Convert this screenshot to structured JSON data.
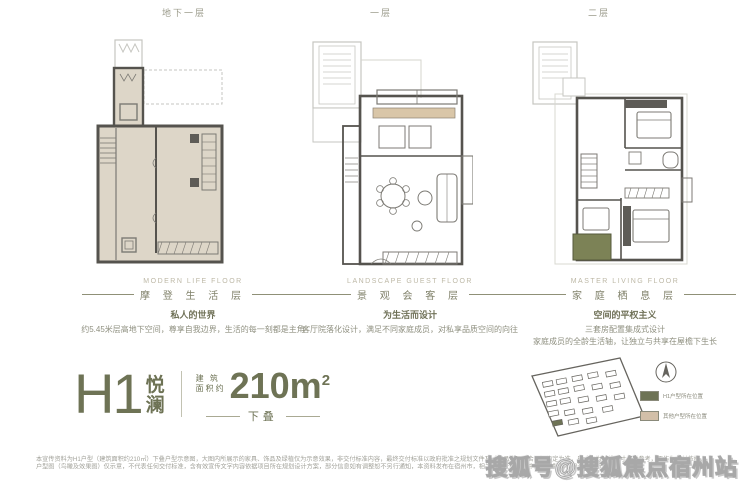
{
  "page": {
    "background": "#ffffff",
    "accent": "#6e7355",
    "plan_fill": "#ddd6c8",
    "terrace_green": "#7c8256",
    "legend_tan": "#d2bfa8"
  },
  "plans": [
    {
      "top_label": "地下一层",
      "caption_en": "MODERN LIFE FLOOR",
      "caption_cn": "摩 登 生 活 层",
      "headline": "私人的世界",
      "desc1": "约5.45米层高地下空间，尊享自我边界，生活的每一刻都是主角",
      "desc2": ""
    },
    {
      "top_label": "一层",
      "caption_en": "LANDSCAPE GUEST FLOOR",
      "caption_cn": "景 观 会 客 层",
      "headline": "为生活而设计",
      "desc1": "客厅院落化设计，满足不同家庭成员，对私享品质空间的向往",
      "desc2": ""
    },
    {
      "top_label": "二层",
      "caption_en": "MASTER LIVING FLOOR",
      "caption_cn": "家 庭 栖 息 层",
      "headline": "空间的平权主义",
      "desc1": "三套房配置集成式设计",
      "desc2": "家庭成员的全龄生活轴，让独立与共享在屋檐下生长"
    }
  ],
  "title": {
    "code": "H1",
    "name_char1": "悦",
    "name_char2": "澜",
    "area_prefix_line1": "建 筑",
    "area_prefix_line2": "面积约",
    "area_value": "210m",
    "area_sup": "2",
    "tag": "下叠"
  },
  "siteplan": {
    "legend": [
      {
        "color": "#6e7355",
        "label": "H1户型所在位置"
      },
      {
        "color": "#d2bfa8",
        "label": "其他户型所在位置"
      }
    ]
  },
  "disclaimer": {
    "line1": "本宣传资料为H1户型（建筑面积约210㎡）下叠户型示意图，大图内所展示的家具、饰品及绿植仅为示意效果，非交付标准内容，最终交付标准以政府批准之规划文件及《商品房买卖合同》约定为准，尺寸均为轴线尺寸仅供参考，不作为交付依据。",
    "line2": "户型图（鸟瞰及效果图）仅示意，不代表任何交付标准，含有效宣传文字内容依据项目所在规划设计方案，部分信息如有调整恕不另行通知，本资料发布在宿州市，相关手续正在完善中，最终解释权归开发商所有。"
  },
  "watermark": {
    "text": "搜狐号@搜狐焦点宿州站"
  }
}
